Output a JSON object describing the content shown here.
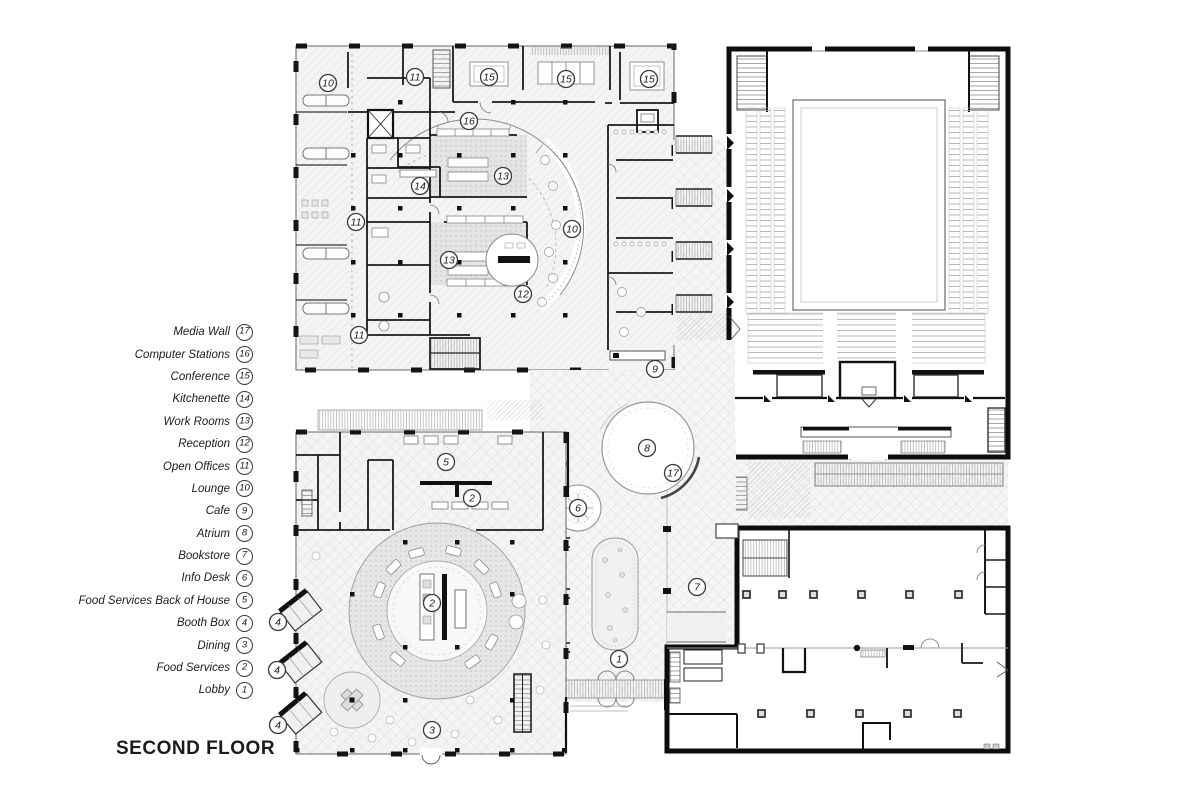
{
  "title": "SECOND FLOOR",
  "legend": {
    "items": [
      {
        "n": "17",
        "label": "Media Wall"
      },
      {
        "n": "16",
        "label": "Computer Stations"
      },
      {
        "n": "15",
        "label": "Conference"
      },
      {
        "n": "14",
        "label": "Kitchenette"
      },
      {
        "n": "13",
        "label": "Work Rooms"
      },
      {
        "n": "12",
        "label": "Reception"
      },
      {
        "n": "11",
        "label": "Open Offices"
      },
      {
        "n": "10",
        "label": "Lounge"
      },
      {
        "n": "9",
        "label": "Cafe"
      },
      {
        "n": "8",
        "label": "Atrium"
      },
      {
        "n": "7",
        "label": "Bookstore"
      },
      {
        "n": "6",
        "label": "Info Desk"
      },
      {
        "n": "5",
        "label": "Food Services Back of House"
      },
      {
        "n": "4",
        "label": "Booth Box"
      },
      {
        "n": "3",
        "label": "Dining"
      },
      {
        "n": "2",
        "label": "Food Services"
      },
      {
        "n": "1",
        "label": "Lobby"
      }
    ]
  },
  "plan": {
    "markers": [
      {
        "n": "10",
        "x": 328,
        "y": 83
      },
      {
        "n": "11",
        "x": 415,
        "y": 77
      },
      {
        "n": "15",
        "x": 489,
        "y": 77
      },
      {
        "n": "15",
        "x": 566,
        "y": 79
      },
      {
        "n": "15",
        "x": 649,
        "y": 79
      },
      {
        "n": "16",
        "x": 469,
        "y": 121
      },
      {
        "n": "14",
        "x": 420,
        "y": 186
      },
      {
        "n": "13",
        "x": 503,
        "y": 176
      },
      {
        "n": "11",
        "x": 356,
        "y": 222
      },
      {
        "n": "10",
        "x": 572,
        "y": 229
      },
      {
        "n": "13",
        "x": 449,
        "y": 260
      },
      {
        "n": "12",
        "x": 523,
        "y": 294
      },
      {
        "n": "11",
        "x": 359,
        "y": 335
      },
      {
        "n": "9",
        "x": 655,
        "y": 369
      },
      {
        "n": "8",
        "x": 647,
        "y": 448
      },
      {
        "n": "17",
        "x": 673,
        "y": 473
      },
      {
        "n": "6",
        "x": 578,
        "y": 508
      },
      {
        "n": "7",
        "x": 697,
        "y": 587
      },
      {
        "n": "5",
        "x": 446,
        "y": 462
      },
      {
        "n": "2",
        "x": 472,
        "y": 498
      },
      {
        "n": "2",
        "x": 432,
        "y": 603
      },
      {
        "n": "1",
        "x": 619,
        "y": 659
      },
      {
        "n": "3",
        "x": 432,
        "y": 730
      },
      {
        "n": "4",
        "x": 278,
        "y": 622
      },
      {
        "n": "4",
        "x": 277,
        "y": 670
      },
      {
        "n": "4",
        "x": 278,
        "y": 725
      }
    ],
    "colors": {
      "ink": "#141414",
      "wall_gray": "#777777",
      "hatch_gray": "#cccccc",
      "paper": "#ffffff"
    }
  }
}
